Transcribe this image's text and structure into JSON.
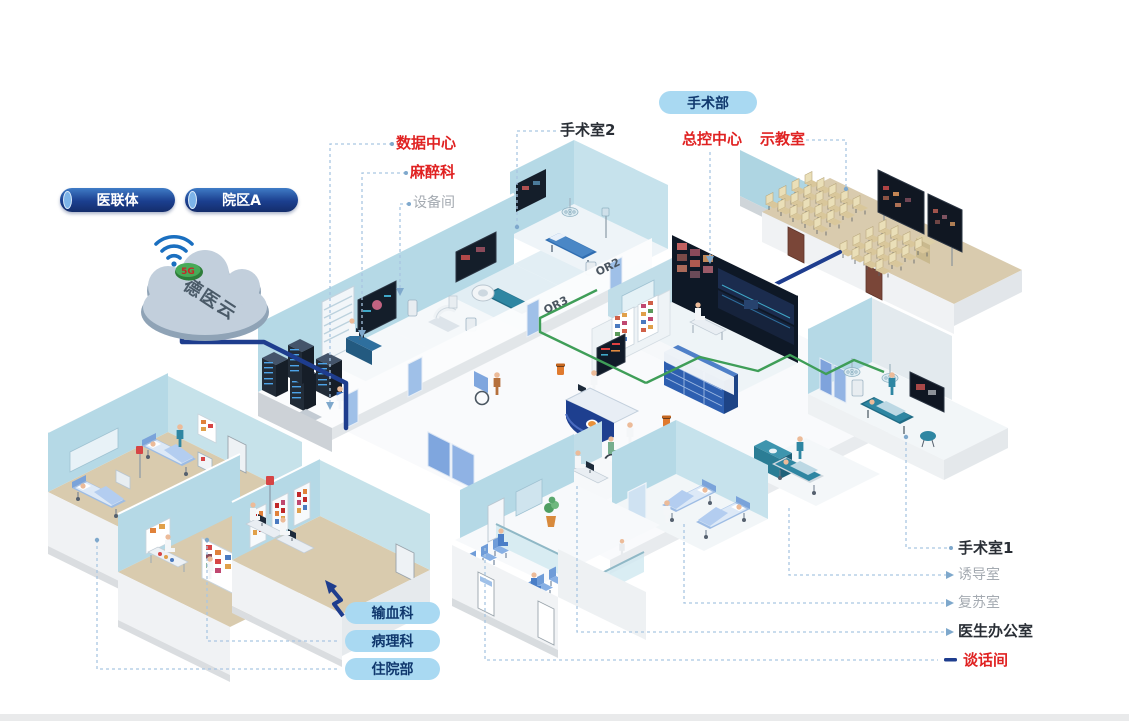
{
  "legend": {
    "org_pills": [
      {
        "label": "医联体"
      },
      {
        "label": "院区A"
      }
    ],
    "dept_pill": {
      "label": "手术部"
    },
    "callouts": {
      "data_center": "数据中心",
      "anesthesiology": "麻醉科",
      "equipment_room": "设备间",
      "operating_room_2": "手术室2",
      "master_control": "总控中心",
      "demo_classroom": "示教室",
      "operating_room_1": "手术室1",
      "induction_room": "诱导室",
      "recovery_room": "复苏室",
      "doctor_office": "医生办公室",
      "talk_room": "谈话间"
    },
    "bottom_pills": [
      {
        "label": "输血科"
      },
      {
        "label": "病理科"
      },
      {
        "label": "住院部"
      }
    ]
  },
  "cloud": {
    "name": "德医云",
    "badge": "5G"
  },
  "scene": {
    "or2_mark": "OR2",
    "or3_mark": "OR3"
  },
  "colors": {
    "callout_red": "#e02222",
    "callout_dark": "#2a2f36",
    "callout_gray": "#a4aab1",
    "pill_light_bg": "#a9d9f2",
    "pill_dark_bg": "#1b3f8f",
    "backbone_blue": "#1e3d8e",
    "network_green": "#3f9e58",
    "leader_blue": "#a9c6e2",
    "wall_blue": "#b5d9e6",
    "floor_tan": "#d9cbae"
  }
}
